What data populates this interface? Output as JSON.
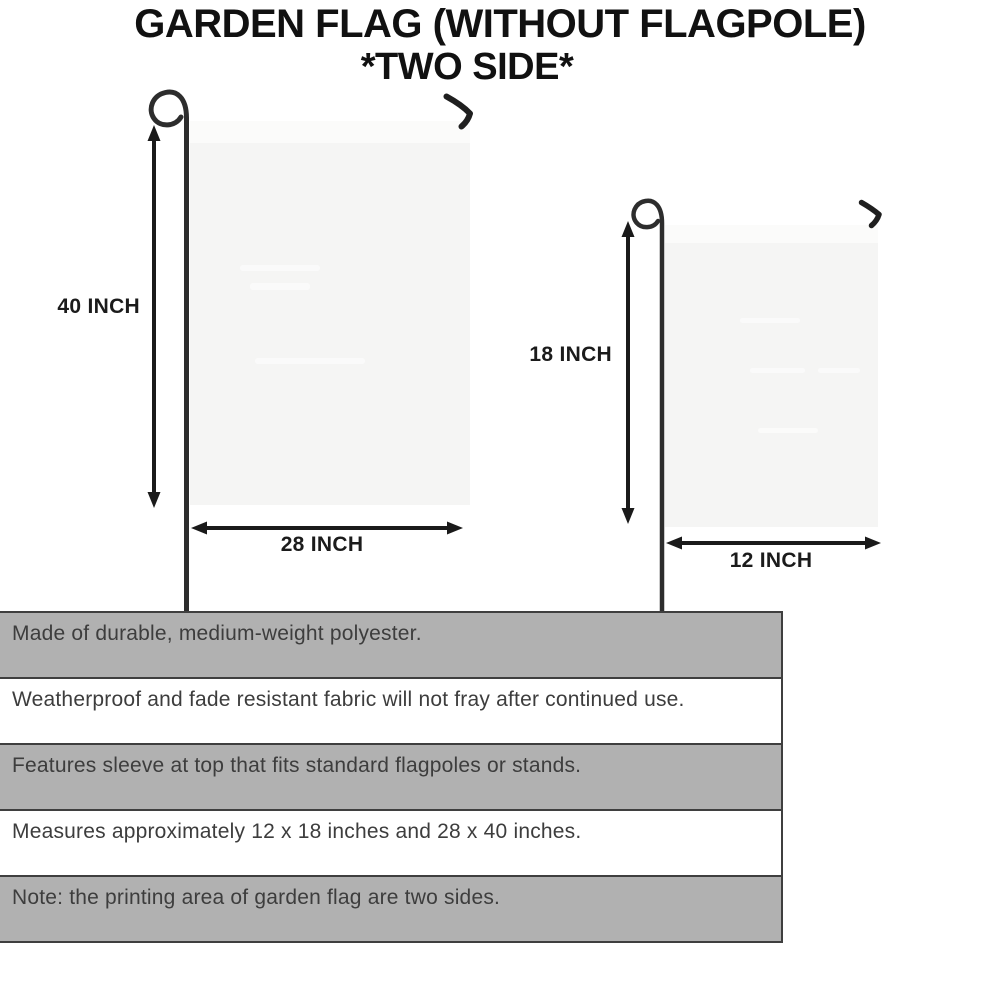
{
  "header": {
    "title": "GARDEN FLAG (WITHOUT FLAGPOLE)",
    "subtitle": "*TWO SIDE*"
  },
  "diagram": {
    "large_flag": {
      "height_label": "40 INCH",
      "width_label": "28 INCH"
    },
    "small_flag": {
      "height_label": "18 INCH",
      "width_label": "12 INCH"
    }
  },
  "specs": {
    "rows": [
      "Made of durable, medium-weight polyester.",
      "Weatherproof and fade resistant fabric will not fray after continued use.",
      "Features sleeve at top that fits standard flagpoles or stands.",
      "Measures approximately 12 x 18 inches and 28 x 40 inches.",
      "Note: the printing area of garden flag are two sides."
    ]
  },
  "colors": {
    "bg": "#ffffff",
    "titleColor": "#111111",
    "pole": "#2d2d2d",
    "hook": "#1f1f1f",
    "flagFill": "#f5f5f4",
    "flagSleeve": "#fbfbfa",
    "arrow": "#1a1a1a",
    "labelColor": "#1b1b1b",
    "stripeGray": "#b1b1b1",
    "rowWhite": "#ffffff",
    "tableBorder": "#3f3f3f",
    "specText": "#3d3d3d"
  }
}
